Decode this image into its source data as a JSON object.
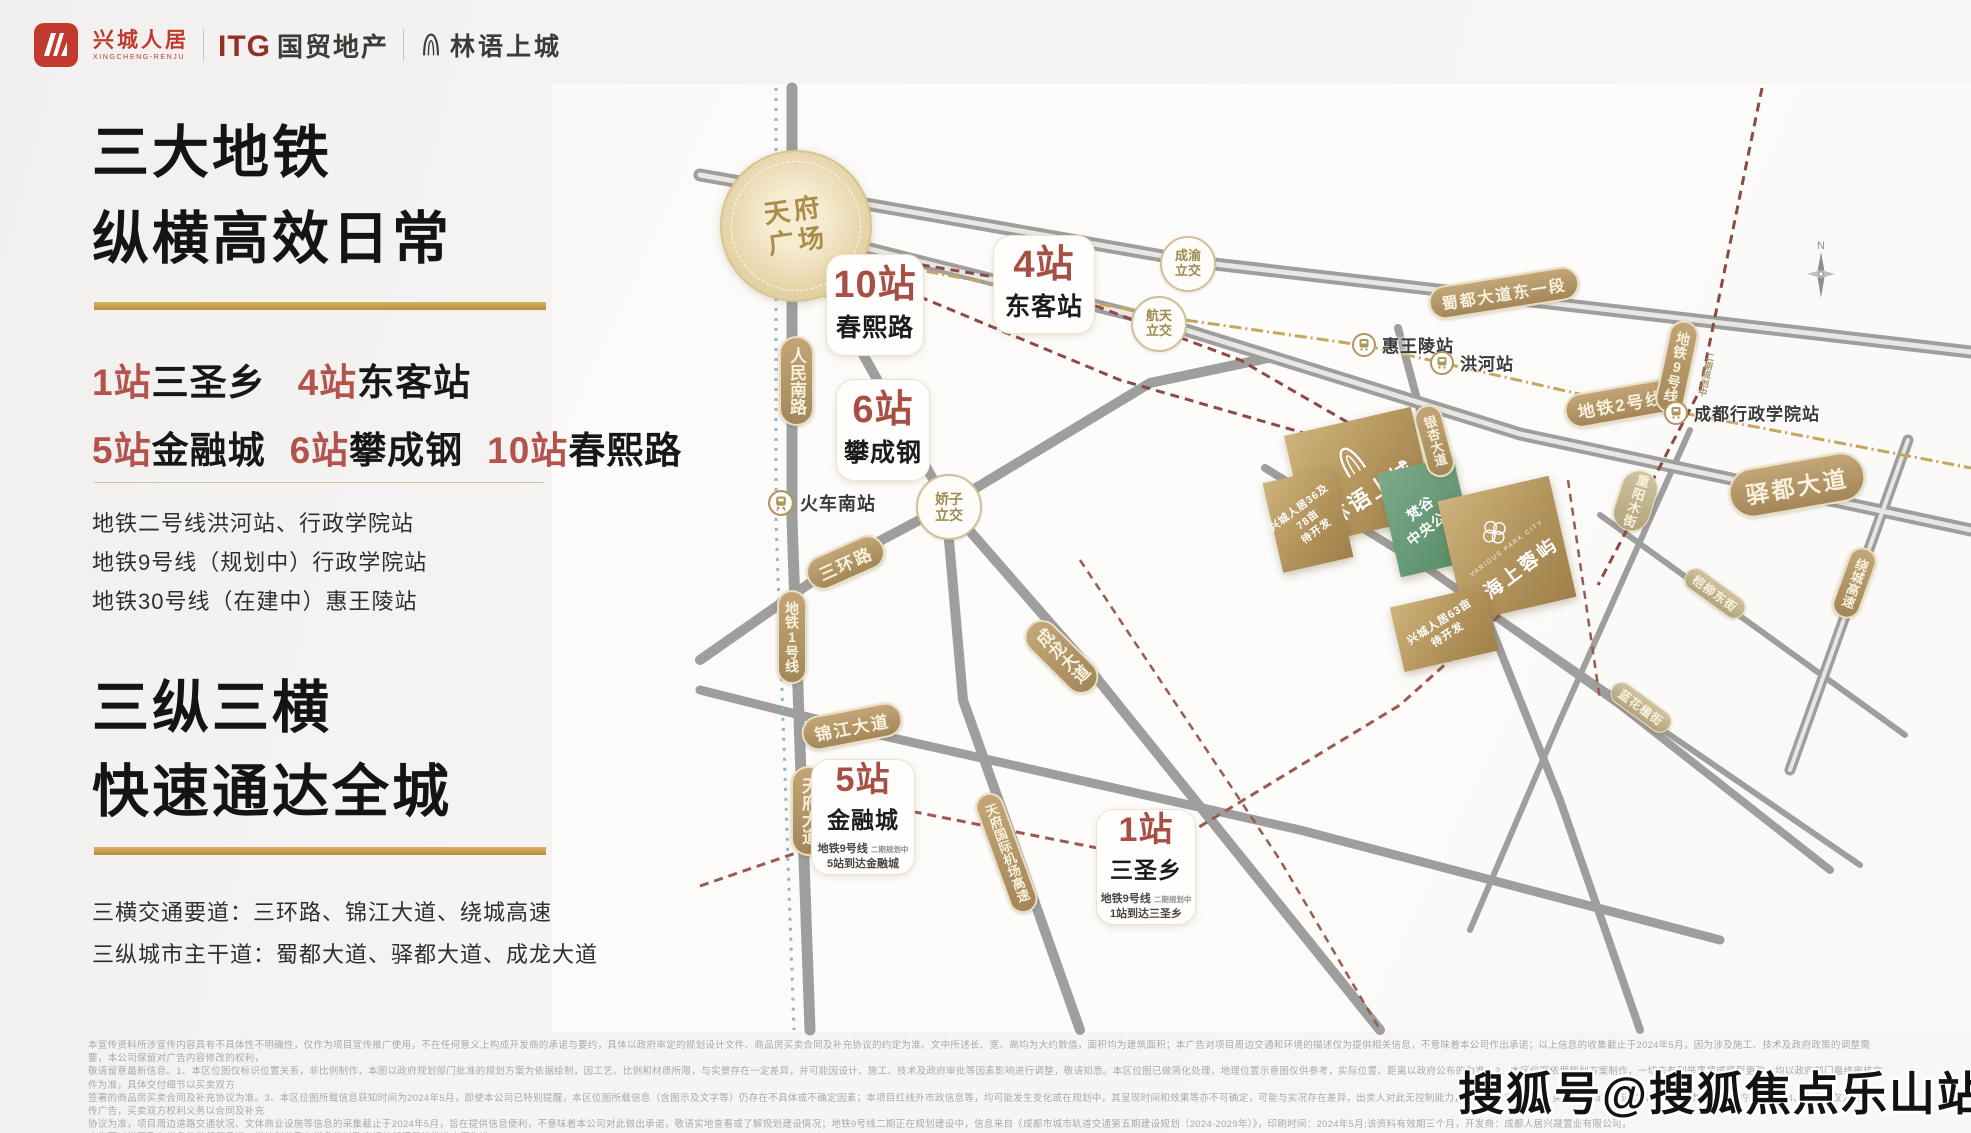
{
  "header": {
    "brand1": "兴城人居",
    "brand1_sub": "XINGCHENG-RENJU",
    "brand2_itg": "ITG",
    "brand2": "国贸地产",
    "brand3": "林语上城"
  },
  "left_panel": {
    "heading1_line1": "三大地铁",
    "heading1_line2": "纵横高效日常",
    "stations_row1": [
      {
        "label": "1站",
        "name": "三圣乡"
      },
      {
        "label": "4站",
        "name": "东客站"
      }
    ],
    "stations_row2": [
      {
        "label": "5站",
        "name": "金融城"
      },
      {
        "label": "6站",
        "name": "攀成钢"
      },
      {
        "label": "10站",
        "name": "春熙路"
      }
    ],
    "metro_lines": [
      "地铁二号线洪河站、行政学院站",
      "地铁9号线（规划中）行政学院站",
      "地铁30号线（在建中）惠王陵站"
    ],
    "heading2_line1": "三纵三横",
    "heading2_line2": "快速通达全城",
    "road_lines": [
      "三横交通要道：三环路、锦江大道、绕城高速",
      "三纵城市主干道：蜀都大道、驿都大道、成龙大道"
    ]
  },
  "map": {
    "plaza": "天府广场",
    "compass_n": "N",
    "pills": {
      "renmin": "人民南路",
      "metro1": "地铁1号线",
      "tianfu": "天府大道",
      "sanhuan": "三环路",
      "jinjiang": "锦江大道",
      "chenglong": "成龙大道",
      "airport": "天府国际机场高速",
      "shudu": "蜀都大道东一段",
      "metro2": "地铁2号线",
      "metro9": "地铁9号线",
      "yidu": "驿都大道",
      "yinxing": "银杏大道",
      "chongyang": "重阳木街",
      "raocheng": "绕城高速",
      "qiliu": "桤柳东街",
      "lanhua": "蓝花楹街"
    },
    "metro9_note": "二期规划中",
    "badges": [
      {
        "label": "10站",
        "name": "春熙路"
      },
      {
        "label": "4站",
        "name": "东客站"
      },
      {
        "label": "6站",
        "name": "攀成钢"
      },
      {
        "label": "5站",
        "name": "金融城",
        "sub_line": "地铁9号线",
        "sub_note": "二期规划中",
        "sub_dest": "5站到达金融城"
      },
      {
        "label": "1站",
        "name": "三圣乡",
        "sub_line": "地铁9号线",
        "sub_note": "二期规划中",
        "sub_dest": "1站到达三圣乡"
      }
    ],
    "stations": {
      "south_rail": "火车南站",
      "huiwangling": "惠王陵站",
      "honghe": "洪河站",
      "xingzheng": "成都行政学院站"
    },
    "interchanges": {
      "chengyu": "成渝立交",
      "hangtian": "航天立交",
      "jiaozi": "娇子立交"
    },
    "parcels": {
      "linyu": {
        "name": "林语上城"
      },
      "xc3678": {
        "l1": "兴城人居36及78亩",
        "l2": "待开发"
      },
      "park": {
        "l1": "梵谷",
        "l2": "中央公园"
      },
      "haishang": {
        "en": "VARIOUS PARK CITY",
        "name": "海上蓉屿"
      },
      "xc63": {
        "l1": "兴城人居63亩",
        "l2": "待开发"
      }
    }
  },
  "footer": {
    "disclaimer_lines": [
      "本宣传资料所涉宣传内容具有不具体性不明确性，仅作为项目宣传推广使用，不在任何意义上构成开发商的承诺与要约，具体以政府审定的规划设计文件、商品房买卖合同及补充协议的约定为准。文中所述长、宽、高均为大约数值，面积均为建筑面积；本广告对项目周边交通和环境的描述仅为提供相关信息，不意味着本公司作出承诺；以上信息的收集截止于2024年5月，因为涉及施工、技术及政府政策的调整需要，本公司保留对广告内容修改的权利，",
      "敬请留意最新信息。1、本区位图仅标识位置关系，非比例制作，本图以政府规划部门批准的规划方案为依据绘制，因工艺、比例和材质所限，与实景存在一定差异，并可能因设计、施工、技术及政府审批等因素影响进行调整，敬请知悉。本区位图已做简化处理，地理位置示意图仅供参考，实际位置、距离以政府公布的为准。2、本区位图依据规划方案制作，一切未有列举事项或模型更改，均以政府部门最终审核文件为准，具体交付细节以买卖双方",
      "签署的商品房买卖合同及补充协议为准。3、本区位图所载信息获知时间为2024年5月，即使本公司已特别提醒，本区位图所载信息（含图示及文字等）仍存在不具体或不确定因素；本项目红线外市政信息等，均可能发生变化或在规划中，其呈现时间和效果等亦不可确定，可能与实况存在差异，出卖人对此无控制能力，且不属于义务范畴，买受人应自行查证了解，不作为本公司的要约或承诺。4、本广告仅为形象宣传广告，买卖双方权利义务以合同及补充",
      "协议为准，项目周边道路交通状况、文体商业设施等信息的采集截止于2024年5月，旨在提供信息便利，不意味着本公司对此做出承诺，敬请实地查看或了解规划建设情况；地铁9号线二期正在规划建设中，信息来自《成都市城市轨道交通第五期建设规划（2024-2029年）》，印刷时间：2024年5月;该资料有效期三个月，开发商：成都人居兴晟置业有限公司，",
      "广告不对学区及入学条件做任何承诺，学校划分及入学条件以政府相关部门最终批准方案为准。"
    ],
    "watermark": "搜狐号@搜狐焦点乐山站"
  }
}
